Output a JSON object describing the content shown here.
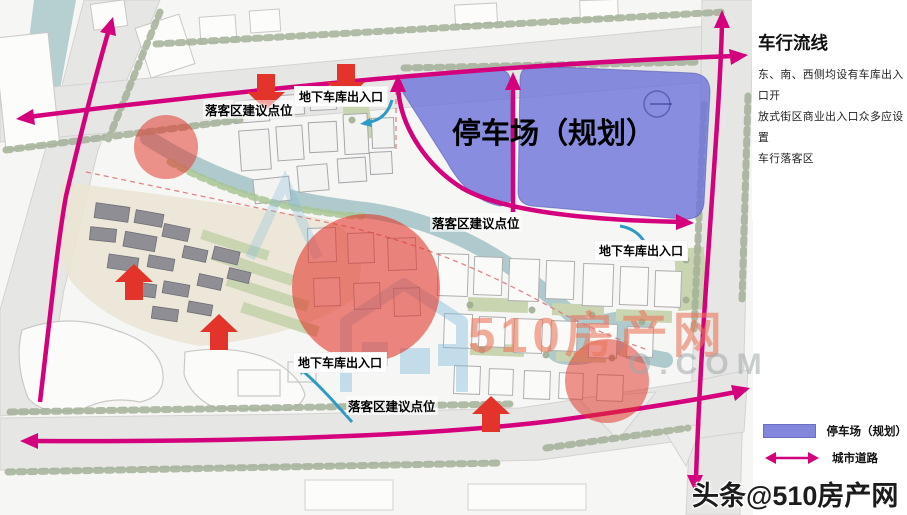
{
  "panel": {
    "title": "车行流线",
    "body": [
      "东、南、西侧均设有车库出入口开",
      "放式街区商业出入口众多应设置",
      "车行落客区"
    ]
  },
  "map": {
    "parking_area_label": "停车场（规划）",
    "dropoff_label_top": "落客区建议点位",
    "garage_label_top": "地下车库出入口",
    "dropoff_label_mid": "落客区建议点位",
    "garage_label_mid": "地下车库出入口",
    "garage_label_bottom": "地下车库出入口",
    "dropoff_label_bottom": "落客区建议点位"
  },
  "legend": {
    "parking_label": "停车场（规划）",
    "road_label": "城市道路"
  },
  "watermark": {
    "brand": "510房产网",
    "domain_suffix": "O.COM",
    "credit": "头条@510房产网"
  },
  "colors": {
    "flow_magenta": "#D4017C",
    "marker_red": "#E2342A",
    "parking_blue": "#8286DD",
    "canal_teal": "#AECACC"
  }
}
